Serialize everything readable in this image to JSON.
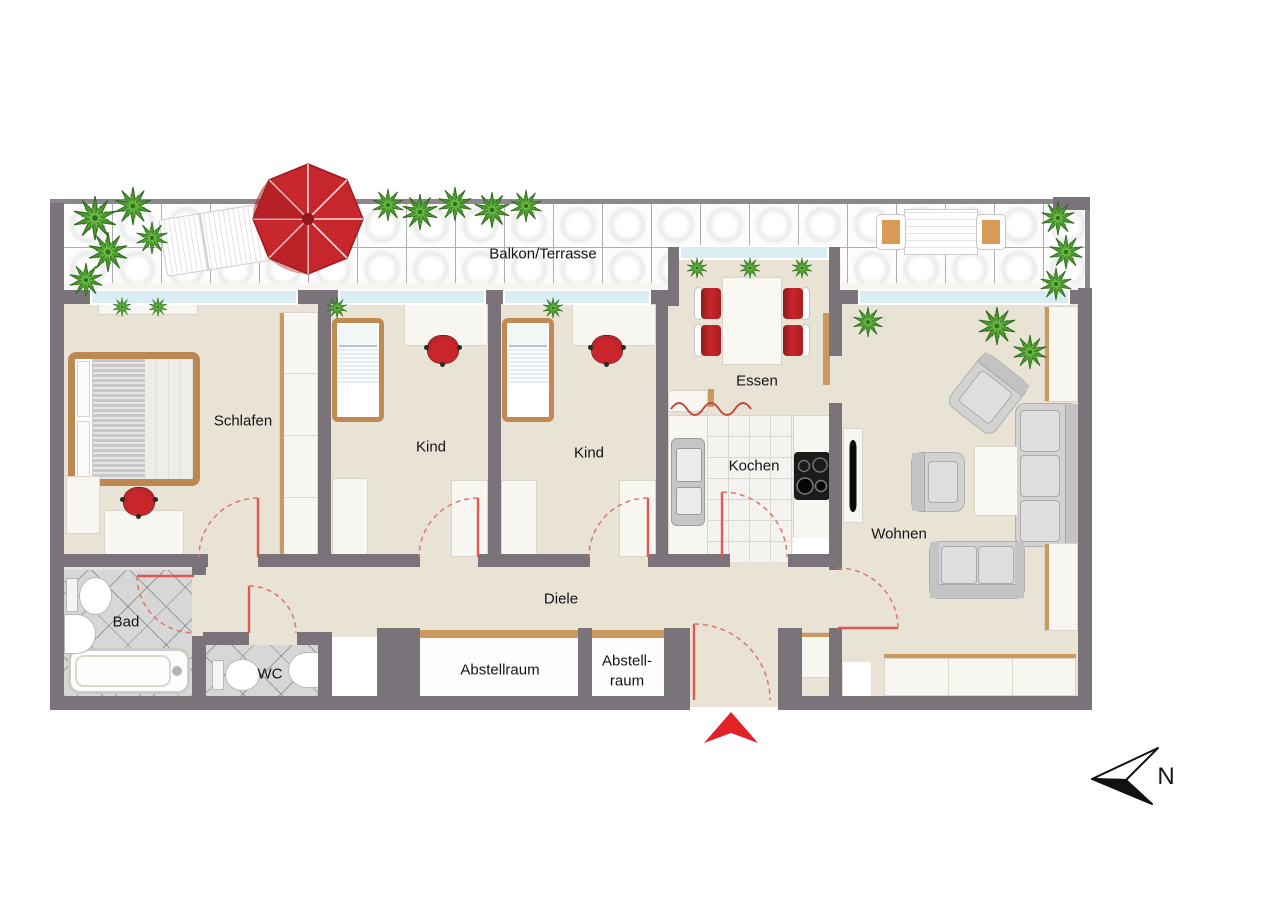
{
  "plan": {
    "balcony_label": "Balkon/Terrasse",
    "rooms": {
      "schlafen": "Schlafen",
      "kind1": "Kind",
      "kind2": "Kind",
      "essen": "Essen",
      "kochen": "Kochen",
      "wohnen": "Wohnen",
      "diele": "Diele",
      "bad": "Bad",
      "wc": "WC",
      "abstellraum": "Abstellraum",
      "abstell2_line1": "Abstell-",
      "abstell2_line2": "raum"
    },
    "compass": {
      "north_label": "N"
    }
  },
  "colors": {
    "wall": "#7a747a",
    "floor_beige": "#e9e3d6",
    "window_glass": "#d9edf2",
    "accent_red": "#c9252b",
    "door_swing_red": "#d9776d",
    "wood": "#c9995e",
    "plant_green": "#4d9c31",
    "bath_tile_gray": "#d7d7d7",
    "balcony_tile_white": "#fcfcfc",
    "furniture_gray": "#d2d2d2"
  },
  "icons": [
    "north-arrow-icon",
    "entry-arrow-icon",
    "umbrella-icon",
    "plant-icon",
    "door-swing-icon",
    "stove-icon",
    "sink-icon",
    "bathtub-icon",
    "toilet-icon"
  ]
}
